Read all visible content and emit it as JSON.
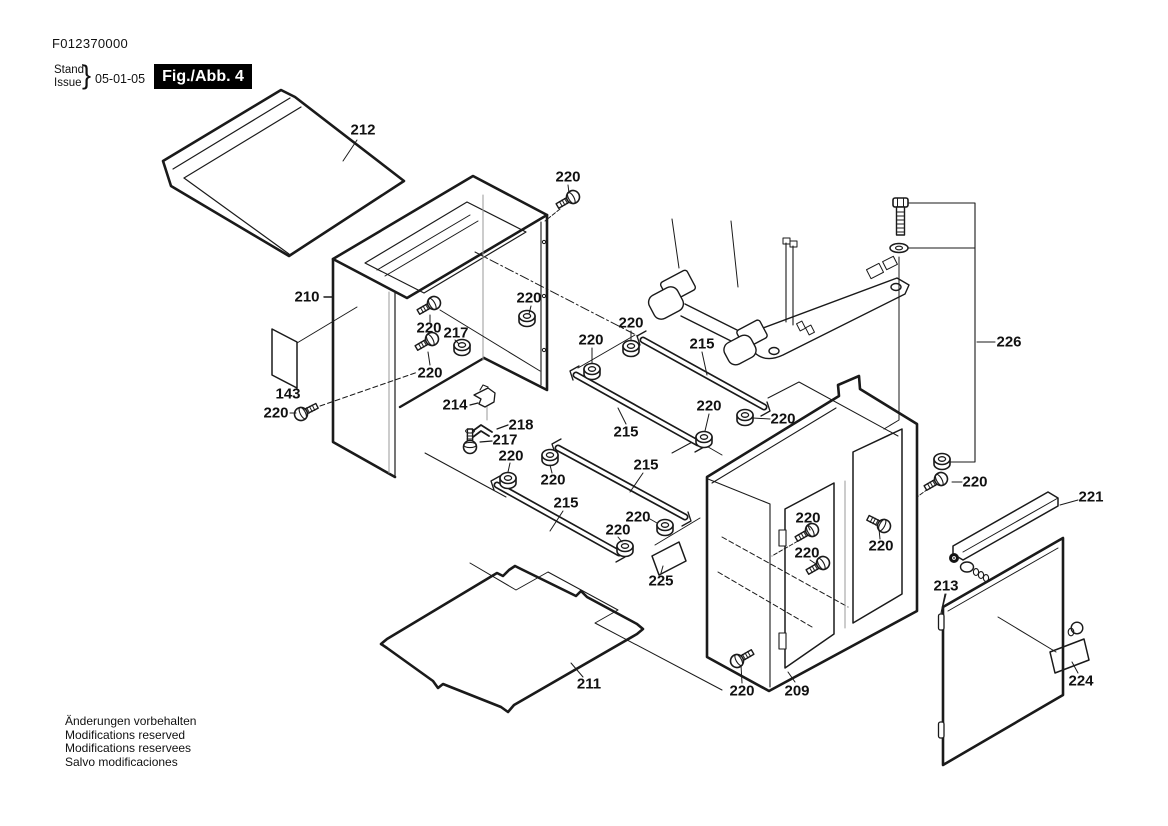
{
  "header": {
    "doc_number": "F012370000",
    "stand_label": "Stand",
    "issue_label": "Issue",
    "brace": "}",
    "date": "05-01-05",
    "figure_label": "Fig./Abb. 4"
  },
  "footer": {
    "lines": [
      "Änderungen vorbehalten",
      "Modifications reserved",
      "Modifications reservees",
      "Salvo modificaciones"
    ]
  },
  "diagram": {
    "description": "Exploded parts view of tool stand cabinet assembly, figure 4",
    "colors": {
      "line": "#1a1a1a",
      "gray": "#9a9a9a",
      "background": "#ffffff"
    },
    "part_labels": [
      {
        "text": "212",
        "x": 363,
        "y": 130
      },
      {
        "text": "220",
        "x": 568,
        "y": 177
      },
      {
        "text": "210",
        "x": 307,
        "y": 297
      },
      {
        "text": "220",
        "x": 529,
        "y": 298
      },
      {
        "text": "220",
        "x": 429,
        "y": 328
      },
      {
        "text": "217",
        "x": 456,
        "y": 333
      },
      {
        "text": "220",
        "x": 631,
        "y": 323
      },
      {
        "text": "215",
        "x": 702,
        "y": 344
      },
      {
        "text": "220",
        "x": 591,
        "y": 340
      },
      {
        "text": "220",
        "x": 430,
        "y": 373
      },
      {
        "text": "143",
        "x": 288,
        "y": 394
      },
      {
        "text": "214",
        "x": 455,
        "y": 405
      },
      {
        "text": "220",
        "x": 276,
        "y": 413
      },
      {
        "text": "220",
        "x": 709,
        "y": 406
      },
      {
        "text": "220",
        "x": 783,
        "y": 419
      },
      {
        "text": "218",
        "x": 521,
        "y": 425
      },
      {
        "text": "215",
        "x": 626,
        "y": 432
      },
      {
        "text": "217",
        "x": 505,
        "y": 440
      },
      {
        "text": "220",
        "x": 511,
        "y": 456
      },
      {
        "text": "215",
        "x": 646,
        "y": 465
      },
      {
        "text": "220",
        "x": 553,
        "y": 480
      },
      {
        "text": "220",
        "x": 975,
        "y": 482
      },
      {
        "text": "215",
        "x": 566,
        "y": 503
      },
      {
        "text": "220",
        "x": 638,
        "y": 517
      },
      {
        "text": "220",
        "x": 808,
        "y": 518
      },
      {
        "text": "220",
        "x": 618,
        "y": 530
      },
      {
        "text": "220",
        "x": 881,
        "y": 546
      },
      {
        "text": "220",
        "x": 807,
        "y": 553
      },
      {
        "text": "226",
        "x": 1009,
        "y": 342
      },
      {
        "text": "221",
        "x": 1091,
        "y": 497
      },
      {
        "text": "213",
        "x": 946,
        "y": 586
      },
      {
        "text": "225",
        "x": 661,
        "y": 581
      },
      {
        "text": "211",
        "x": 589,
        "y": 684
      },
      {
        "text": "224",
        "x": 1081,
        "y": 681
      },
      {
        "text": "220",
        "x": 742,
        "y": 691
      },
      {
        "text": "209",
        "x": 797,
        "y": 691
      }
    ]
  }
}
